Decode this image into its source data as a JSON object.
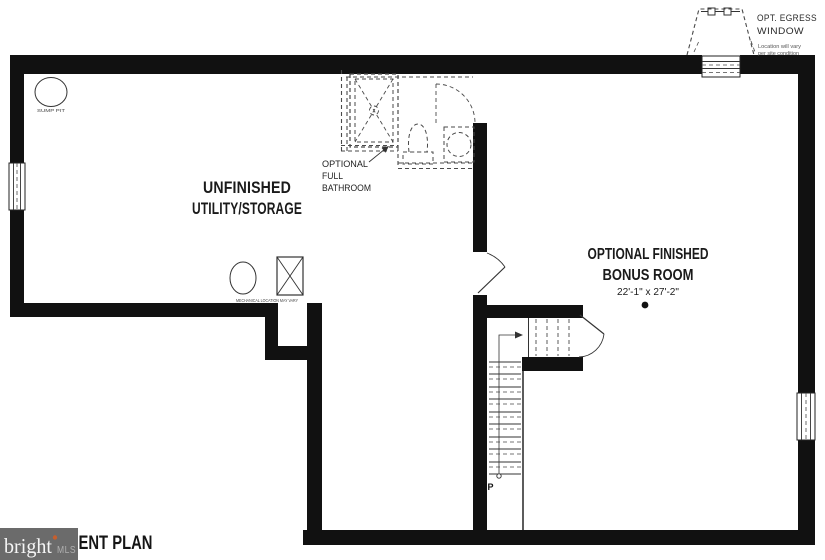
{
  "colors": {
    "wall": "#111111",
    "line": "#333333",
    "dashed": "#4a4a4a",
    "background": "#ffffff",
    "watermark_box": "#6b6b6b",
    "watermark_brand": "#f5f5f5",
    "watermark_mls": "#b0b0b0",
    "watermark_tm": "#c65f2e"
  },
  "labels": {
    "utility_line1": "UNFINISHED",
    "utility_line2": "UTILITY/STORAGE",
    "bonus_line1": "OPTIONAL FINISHED",
    "bonus_line2": "BONUS ROOM",
    "bonus_dimensions": "22'-1\" x 27'-2\"",
    "bath_line1": "OPTIONAL",
    "bath_line2": "FULL",
    "bath_line3": "BATHROOM",
    "egress_line1": "OPT. EGRESS",
    "egress_line2": "WINDOW",
    "egress_note1": "Location will vary",
    "egress_note2": "per site condition",
    "sump_pit": "SUMP PIT",
    "mechanical": "MECHANICAL LOCATION MAY VARY",
    "stairs_up": "UP"
  },
  "watermark": {
    "brand": "bright",
    "suffix": "MLS"
  },
  "title": {
    "visible_text": "ENT PLAN"
  }
}
